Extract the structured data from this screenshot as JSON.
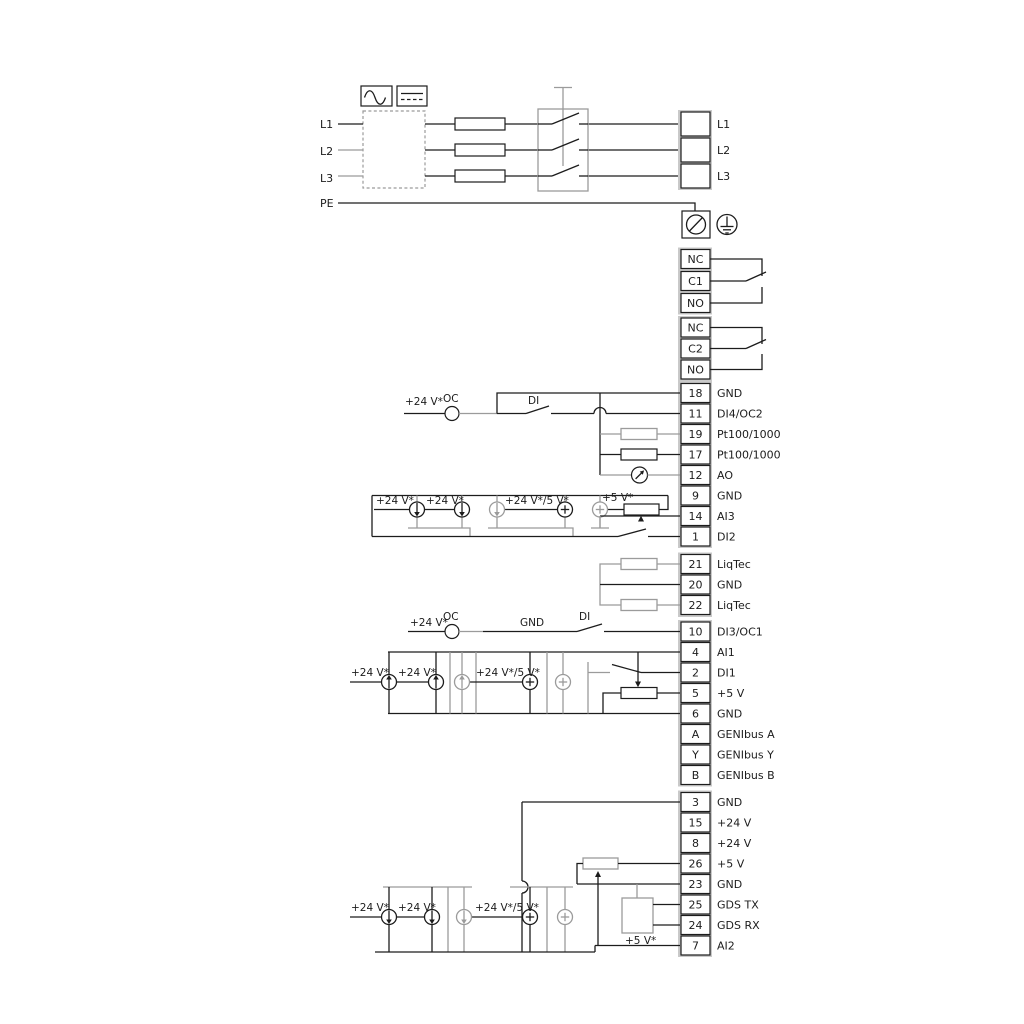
{
  "power": {
    "inputs": [
      {
        "label": "L1"
      },
      {
        "label": "L2"
      },
      {
        "label": "L3"
      },
      {
        "label": "PE"
      }
    ],
    "outputs": [
      {
        "label": "L1"
      },
      {
        "label": "L2"
      },
      {
        "label": "L3"
      }
    ]
  },
  "relay1": {
    "t": [
      {
        "label": "NC"
      },
      {
        "label": "C1"
      },
      {
        "label": "NO"
      }
    ]
  },
  "relay2": {
    "t": [
      {
        "label": "NC"
      },
      {
        "label": "C2"
      },
      {
        "label": "NO"
      }
    ]
  },
  "io1": [
    {
      "num": "18",
      "label": "GND"
    },
    {
      "num": "11",
      "label": "DI4/OC2"
    },
    {
      "num": "19",
      "label": "Pt100/1000"
    },
    {
      "num": "17",
      "label": "Pt100/1000"
    },
    {
      "num": "12",
      "label": "AO"
    },
    {
      "num": "9",
      "label": "GND"
    },
    {
      "num": "14",
      "label": "AI3"
    },
    {
      "num": "1",
      "label": "DI2"
    }
  ],
  "liqtec": [
    {
      "num": "21",
      "label": "LiqTec"
    },
    {
      "num": "20",
      "label": "GND"
    },
    {
      "num": "22",
      "label": "LiqTec"
    }
  ],
  "io2": [
    {
      "num": "10",
      "label": "DI3/OC1"
    },
    {
      "num": "4",
      "label": "AI1"
    },
    {
      "num": "2",
      "label": "DI1"
    },
    {
      "num": "5",
      "label": "+5 V"
    },
    {
      "num": "6",
      "label": "GND"
    },
    {
      "num": "A",
      "label": "GENIbus A"
    },
    {
      "num": "Y",
      "label": "GENIbus Y"
    },
    {
      "num": "B",
      "label": "GENIbus B"
    }
  ],
  "io3": [
    {
      "num": "3",
      "label": "GND"
    },
    {
      "num": "15",
      "label": "+24 V"
    },
    {
      "num": "8",
      "label": "+24 V"
    },
    {
      "num": "26",
      "label": "+5 V"
    },
    {
      "num": "23",
      "label": "GND"
    },
    {
      "num": "25",
      "label": "GDS TX"
    },
    {
      "num": "24",
      "label": "GDS RX"
    },
    {
      "num": "7",
      "label": "AI2"
    }
  ],
  "labels": {
    "v24": "+24 V*",
    "v24_5": "+24 V*/5 V*",
    "v5": "+5 V*",
    "oc": "OC",
    "di": "DI",
    "gnd": "GND"
  }
}
